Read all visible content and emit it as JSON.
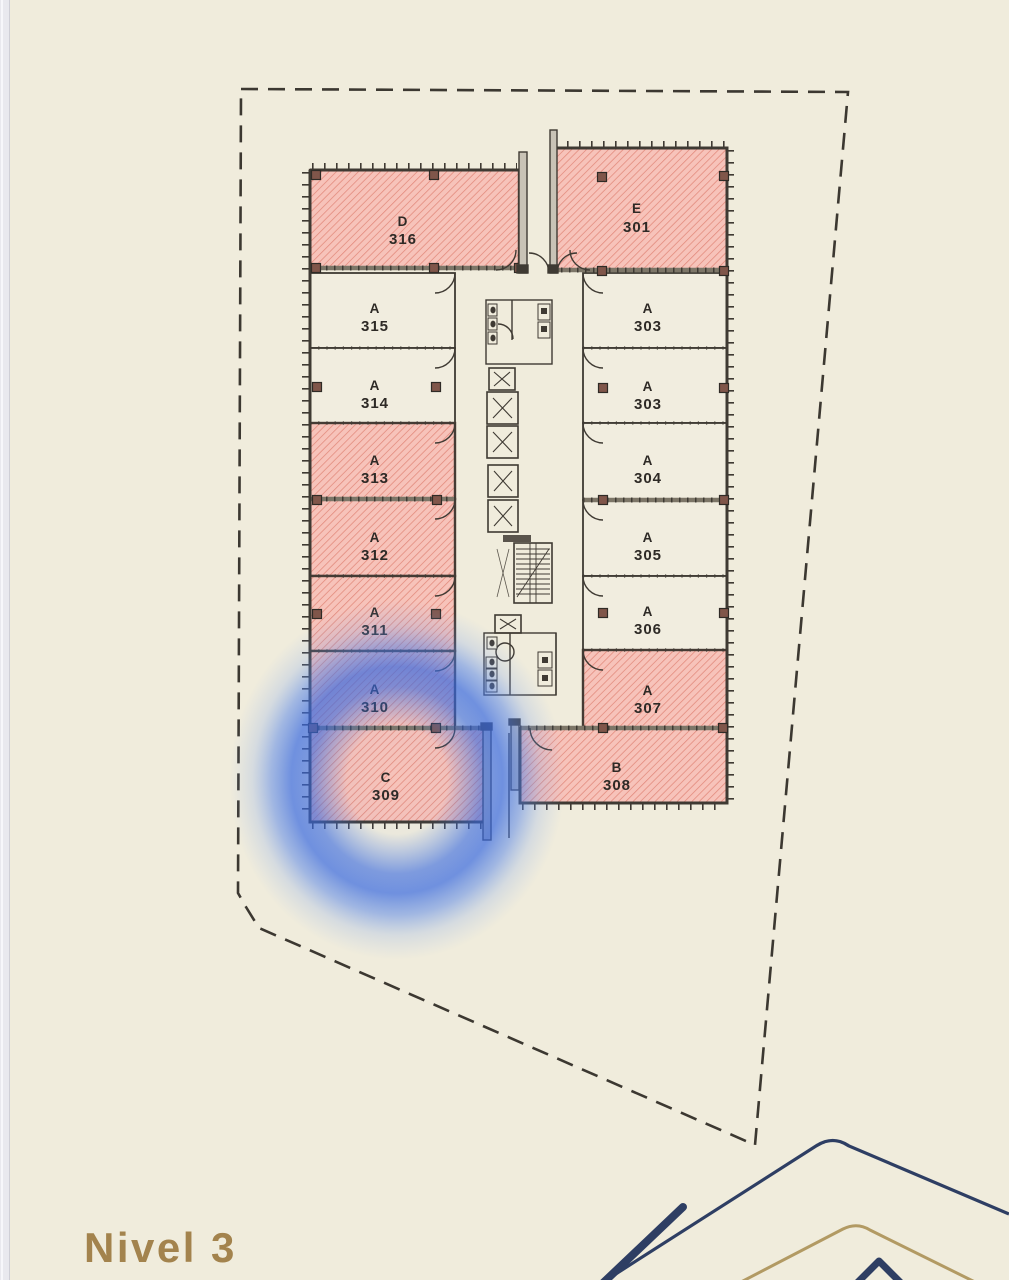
{
  "page": {
    "level_label": "Nivel 3",
    "background_color": "#f0ecdc",
    "title_color": "#a3834d"
  },
  "plan": {
    "boundary_style": "dashed-property-line",
    "selected_area": "C 309",
    "highlight_ring_color": "#3d74e6",
    "hatched_fill_color": "#f7c3ba",
    "hatch_line_color": "#e2897b",
    "highlighted_unit_numbers": [
      "316",
      "301",
      "313",
      "312",
      "311",
      "310",
      "309",
      "307",
      "308"
    ]
  },
  "units": [
    {
      "letter": "D",
      "number": "316",
      "highlighted": true
    },
    {
      "letter": "E",
      "number": "301",
      "highlighted": true
    },
    {
      "letter": "A",
      "number": "315",
      "highlighted": false
    },
    {
      "letter": "A",
      "number": "303",
      "highlighted": false
    },
    {
      "letter": "A",
      "number": "314",
      "highlighted": false
    },
    {
      "letter": "A",
      "number": "303",
      "highlighted": false
    },
    {
      "letter": "A",
      "number": "313",
      "highlighted": true
    },
    {
      "letter": "A",
      "number": "304",
      "highlighted": false
    },
    {
      "letter": "A",
      "number": "312",
      "highlighted": true
    },
    {
      "letter": "A",
      "number": "305",
      "highlighted": false
    },
    {
      "letter": "A",
      "number": "311",
      "highlighted": true
    },
    {
      "letter": "A",
      "number": "306",
      "highlighted": false
    },
    {
      "letter": "A",
      "number": "310",
      "highlighted": true
    },
    {
      "letter": "A",
      "number": "307",
      "highlighted": true
    },
    {
      "letter": "C",
      "number": "309",
      "highlighted": true
    },
    {
      "letter": "B",
      "number": "308",
      "highlighted": true
    }
  ],
  "icons": {
    "elevator": "x-box-icon",
    "stairs": "tread-lines-icon",
    "door": "quarter-arc-icon"
  },
  "colors": {
    "background": "#f0ecdc",
    "wall": "#3f3a33",
    "plain_unit_fill": "#f1eddf",
    "highlight_fill": "#f7c3ba",
    "highlight_hatch": "#e2897b",
    "column_marker": "#80564a",
    "fin_wall_fill": "#c9c3b6",
    "boundary_dash": "#3c3831",
    "ring_blue": "#3d74e6",
    "title_gold": "#a3834d",
    "decor_navy": "#2e3e63",
    "decor_gold": "#b29a63",
    "scrollbar_strip": "#e9e9ee"
  }
}
